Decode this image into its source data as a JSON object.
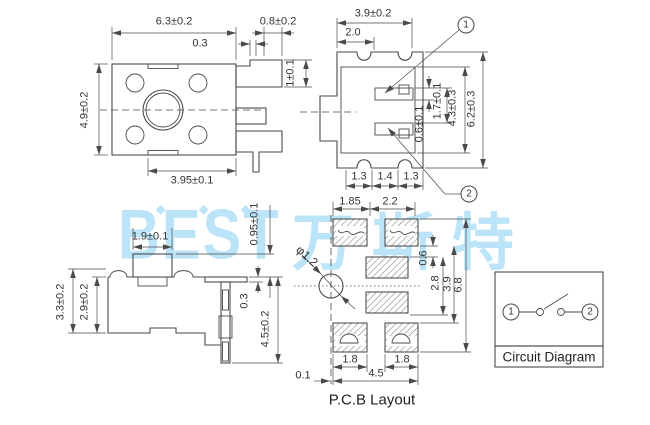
{
  "watermark": {
    "brand": "BEST",
    "brand_cn": "万斯特",
    "diamond": "◆",
    "color": "#bce4f8"
  },
  "views": {
    "top": {
      "width": "6.3±0.2",
      "step": "0.3",
      "lead_gap": "0.8±0.2",
      "lead_height": "1±0.1",
      "height": "4.9±0.2",
      "pitch": "3.95±0.1"
    },
    "front": {
      "width": "3.9±0.2",
      "button_width": "2.0",
      "pin1": "1",
      "pin2": "2",
      "dim_06": "0.6±0.1",
      "dim_17": "1.7±0.1",
      "dim_43": "4.3±0.3",
      "dim_62": "6.2±0.3",
      "pitch_a": "1.3",
      "pitch_b": "1.4",
      "pitch_c": "1.3"
    },
    "side": {
      "button_width": "1.9±0.1",
      "button_height": "0.95±0.1",
      "body_height_outer": "3.3±0.2",
      "body_height": "2.9±0.2",
      "lead_thickness": "0.3",
      "total_height": "4.5±0.2"
    },
    "pcb": {
      "pad_width": "1.85",
      "pad_spacing": "2.2",
      "hole": "φ1.2",
      "gap": "0.6",
      "mid_span": "2.8",
      "row_span": "3.9",
      "total_span": "6.8",
      "pad_a": "1.8",
      "pad_b": "1.8",
      "offset": "0.1",
      "width": "4.5",
      "label": "P.C.B Layout"
    },
    "circuit": {
      "label": "Circuit Diagram",
      "pin1": "1",
      "pin2": "2"
    }
  }
}
